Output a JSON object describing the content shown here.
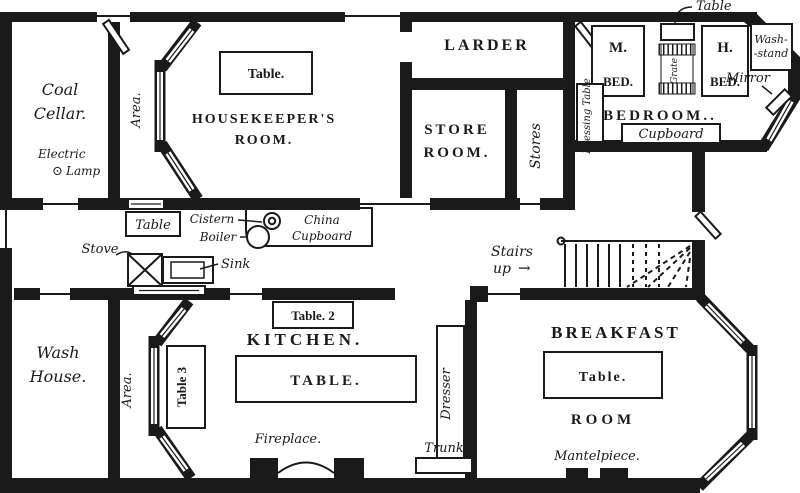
{
  "title": "House basement floor plan",
  "colors": {
    "ink": "#1a1a1a",
    "paper": "#ffffff"
  },
  "rooms": {
    "coal_cellar": {
      "line1": "Coal",
      "line2": "Cellar."
    },
    "housekeepers": {
      "line1": "HOUSEKEEPER'S",
      "line2": "ROOM."
    },
    "larder": {
      "label": "LARDER"
    },
    "store_room": {
      "line1": "STORE",
      "line2": "ROOM."
    },
    "stores": {
      "label": "Stores"
    },
    "bedroom": {
      "label": "BEDROOM.."
    },
    "wash_house": {
      "line1": "Wash",
      "line2": "House."
    },
    "kitchen": {
      "label": "KITCHEN."
    },
    "breakfast": {
      "line1": "BREAKFAST",
      "line2": "ROOM"
    },
    "area_top": {
      "label": "Area."
    },
    "area_bottom": {
      "label": "Area."
    }
  },
  "furniture": {
    "housekeepers_table": {
      "label": "Table."
    },
    "passage_table": {
      "label": "Table"
    },
    "cistern": {
      "label": "Cistern"
    },
    "boiler": {
      "label": "Boiler"
    },
    "china_cupboard": {
      "line1": "China",
      "line2": "Cupboard"
    },
    "dressing_table": {
      "label": "Dressing Table"
    },
    "bedroom_table": {
      "label": "Table"
    },
    "m_bed": {
      "line1": "M.",
      "line2": "BED."
    },
    "grate": {
      "label": "Grate"
    },
    "h_bed": {
      "line1": "H.",
      "line2": "BED."
    },
    "wash_stand": {
      "line1": "Wash-",
      "line2": "-stand"
    },
    "mirror": {
      "label": "Mirror"
    },
    "bedroom_cupboard": {
      "label": "Cupboard"
    },
    "stove": {
      "label": "Stove"
    },
    "sink": {
      "label": "Sink"
    },
    "table2": {
      "label": "Table. 2"
    },
    "table3": {
      "label": "Table 3"
    },
    "kitchen_table": {
      "label": "TABLE."
    },
    "fireplace": {
      "label": "Fireplace."
    },
    "trunk": {
      "label": "Trunk"
    },
    "dresser": {
      "label": "Dresser"
    },
    "breakfast_table": {
      "label": "Table."
    },
    "mantelpiece": {
      "label": "Mantelpiece."
    }
  },
  "fixtures": {
    "electric_lamp": {
      "line1": "Electric",
      "glyph": "⊙",
      "line2": "Lamp"
    }
  },
  "annotations": {
    "stairs": {
      "line1": "Stairs",
      "line2": "up",
      "arrow": "→"
    }
  }
}
